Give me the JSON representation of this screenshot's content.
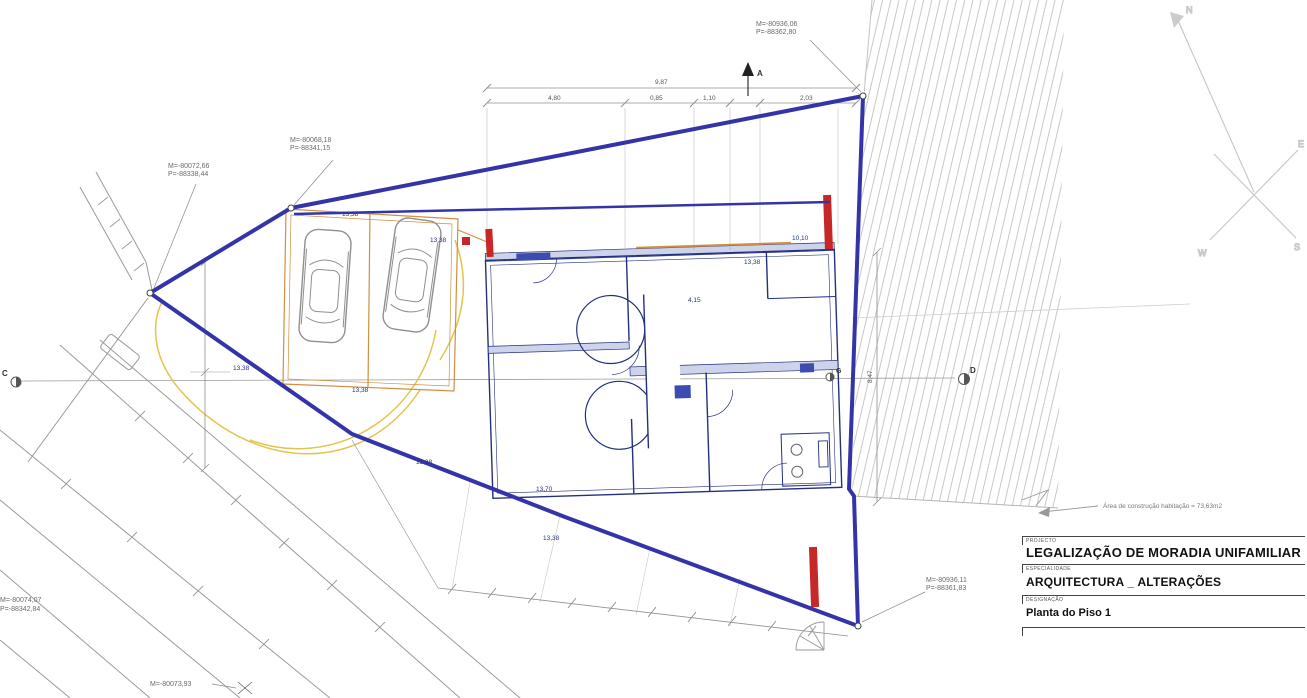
{
  "colors": {
    "boundary_blue": "#3434a8",
    "plan_navy": "#24307e",
    "wall_fill": "#ccd3ea",
    "garage_orange": "#cf9040",
    "path_yellow": "#e2c44f",
    "new_wall_red": "#c62828",
    "dimension_gray": "#909090",
    "hatch_gray": "#c4c4c4"
  },
  "compass": {
    "n": "N",
    "e": "E",
    "w": "W",
    "s": "S"
  },
  "survey_points": {
    "top_right": {
      "m": "M=-80936,06",
      "p": "P=-88362,80"
    },
    "upper_mid": {
      "m": "M=-80068,18",
      "p": "P=-88341,15"
    },
    "upper_left": {
      "m": "M=-80072,66",
      "p": "P=-88338,44"
    },
    "bottom_right": {
      "m": "M=-80936,11",
      "p": "P=-88361,83"
    },
    "bottom_left": {
      "m": "M=-80074,07",
      "p": "P=-88342,84"
    },
    "bottom_mid": {
      "m": "M=-80073,93"
    }
  },
  "dimensions": {
    "top_total": "9,87",
    "seg1": "4,80",
    "seg2": "0,85",
    "seg3": "1,10",
    "seg4": "2,03",
    "right_side": "8,47"
  },
  "levels": {
    "l1": "13,38",
    "l2": "13,38",
    "l3": "13,38",
    "l4": "13,38",
    "l5": "13,70",
    "l6": "13,38",
    "l7": "10,10",
    "l8": "13,38",
    "l9": "4,15",
    "l10": "13,38"
  },
  "markers": {
    "a": "A",
    "c": "C",
    "d": "D",
    "g": "G"
  },
  "note": {
    "area": "Área de construção habitação = 73,63m2"
  },
  "title_block": {
    "project_label": "PROJECTO",
    "project": "LEGALIZAÇÃO DE MORADIA UNIFAMILIAR",
    "specialty_label": "ESPECIALIDADE",
    "specialty": "ARQUITECTURA _ ALTERAÇÕES",
    "drawing_label": "DESIGNAÇÃO",
    "drawing_name": "Planta do Piso 1"
  }
}
